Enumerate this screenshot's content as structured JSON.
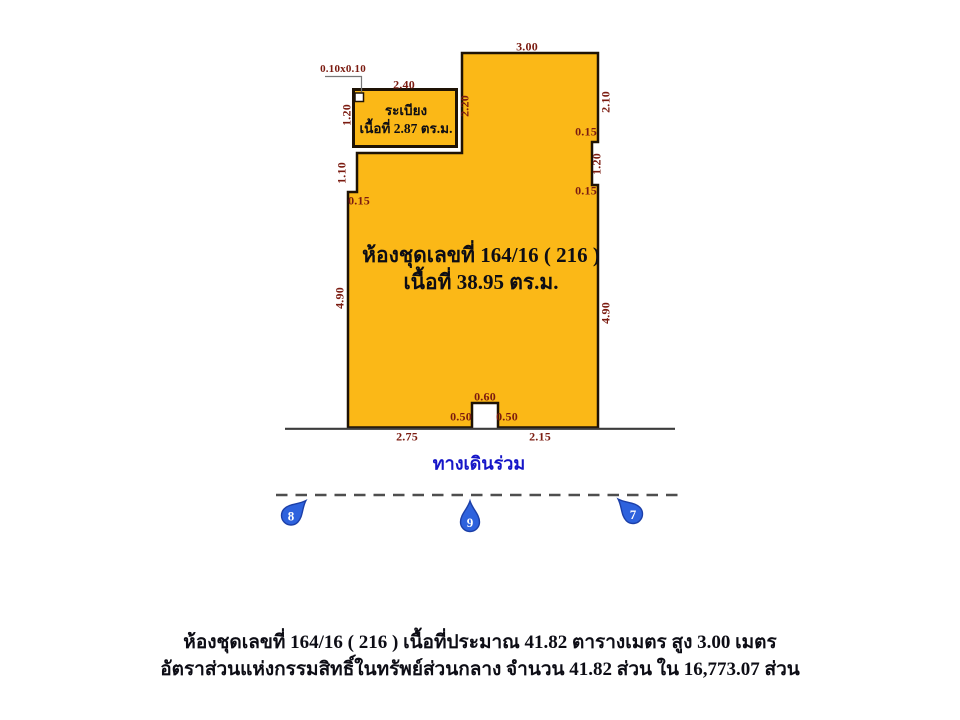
{
  "plan": {
    "unit": {
      "line1": "ห้องชุดเลขที่ 164/16 ( 216 )",
      "line2": "เนื้อที่ 38.95  ตร.ม."
    },
    "balcony": {
      "line1": "ระเบียง",
      "line2": "เนื้อที่ 2.87  ตร.ม."
    },
    "column_label": "0.10x0.10",
    "walkway_label": "ทางเดินร่วม",
    "dims": {
      "top_width": "3.00",
      "balcony_width": "2.40",
      "balcony_height": "1.20",
      "tower_left": "2.20",
      "right_upper": "2.10",
      "right_notch_top": "0.15",
      "right_notch": "1.20",
      "right_notch_bottom": "0.15",
      "left_upper": "1.10",
      "left_step": "0.15",
      "left_lower": "4.90",
      "right_lower": "4.90",
      "door_width": "0.60",
      "door_left": "0.50",
      "door_right": "0.50",
      "bottom_left": "2.75",
      "bottom_right": "2.15"
    },
    "markers": [
      "8",
      "9",
      "7"
    ],
    "colors": {
      "unit_fill": "#FBB817",
      "outline": "#1E1205",
      "dimension_text": "#7B1B10",
      "room_text": "#0D0D15",
      "walkway_text": "#1616C8",
      "marker_fill": "#2E62DD",
      "marker_stroke": "#1C3FA8",
      "line_gray": "#4E4E4E"
    }
  },
  "footer": {
    "line1": "ห้องชุดเลขที่  164/16 ( 216 ) เนื้อที่ประมาณ 41.82  ตารางเมตร  สูง  3.00  เมตร",
    "line2": "อัตราส่วนแห่งกรรมสิทธิ์ในทรัพย์ส่วนกลาง  จำนวน  41.82  ส่วน  ใน  16,773.07  ส่วน"
  }
}
